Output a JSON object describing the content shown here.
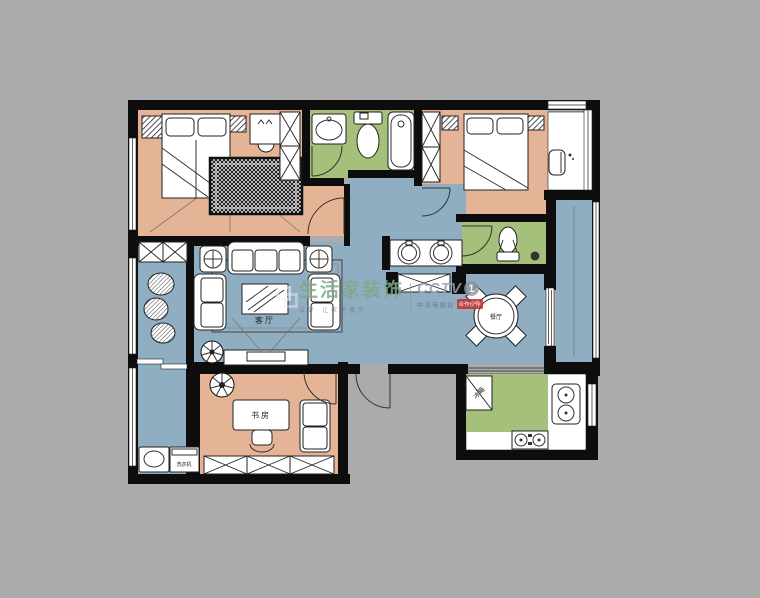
{
  "colors": {
    "bg": "#ababab",
    "wall": "#0d0d0d",
    "bedroom": "#e5b496",
    "living": "#90aec2",
    "bath": "#a5c07a",
    "furniture": "#ffffff",
    "brand_green": "#7da98b",
    "wm_gray": "#97a3af",
    "badge_red": "#c52f2f"
  },
  "labels": {
    "living": "客厅",
    "study": "书房",
    "dining": "餐厅",
    "fridge": "冰箱",
    "washer": "洗衣机"
  },
  "watermark": {
    "brand": "生活家装饰",
    "slogan": "设计·让家更懂你",
    "cctv": "CCTV",
    "channel": "1",
    "station": "中央电视台",
    "badge": "合作伙伴"
  }
}
